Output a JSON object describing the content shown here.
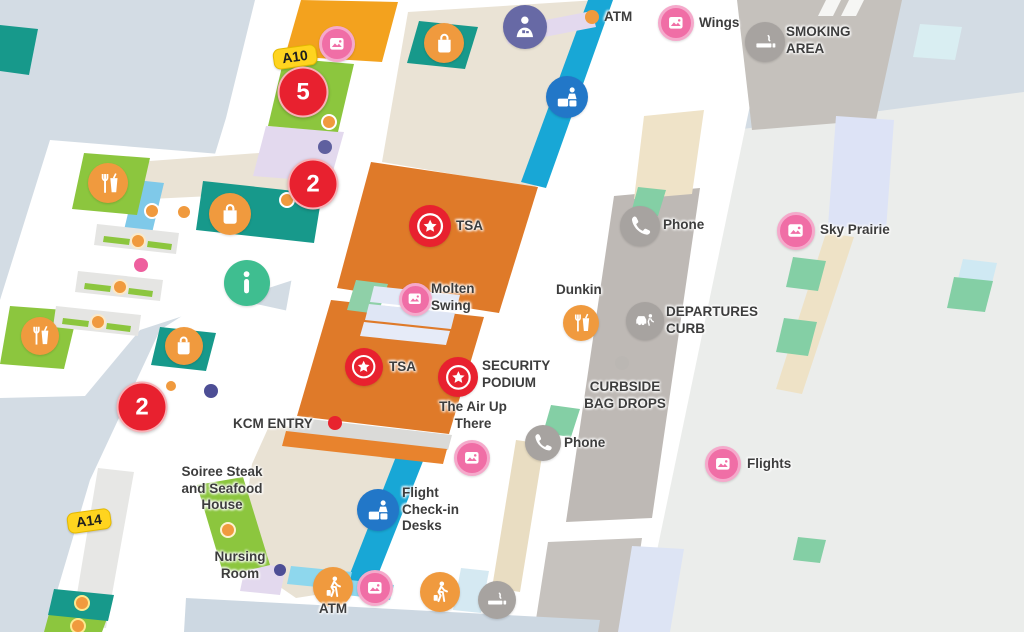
{
  "map": {
    "name": "Airport terminal map",
    "gate_tags": [
      {
        "text": "A10",
        "x": 295,
        "y": 57
      },
      {
        "text": "A14",
        "x": 89,
        "y": 521
      }
    ],
    "count_badges": [
      {
        "text": "5",
        "x": 303,
        "y": 92
      },
      {
        "text": "2",
        "x": 313,
        "y": 184
      },
      {
        "text": "2",
        "x": 142,
        "y": 407
      }
    ],
    "labels": [
      {
        "slug": "atm-top",
        "lines": [
          "ATM"
        ],
        "x": 604,
        "y": 9,
        "align": "left"
      },
      {
        "slug": "wings",
        "lines": [
          "Wings"
        ],
        "x": 699,
        "y": 15,
        "align": "left"
      },
      {
        "slug": "smoking-area",
        "lines": [
          "SMOKING",
          "AREA"
        ],
        "x": 786,
        "y": 24,
        "align": "left"
      },
      {
        "slug": "sky-prairie",
        "lines": [
          "Sky Prairie"
        ],
        "x": 820,
        "y": 222,
        "align": "left"
      },
      {
        "slug": "phone-upper",
        "lines": [
          "Phone"
        ],
        "x": 663,
        "y": 217,
        "align": "left"
      },
      {
        "slug": "departures-curb",
        "lines": [
          "DEPARTURES",
          "CURB"
        ],
        "x": 666,
        "y": 304,
        "align": "left"
      },
      {
        "slug": "dunkin",
        "lines": [
          "Dunkin"
        ],
        "x": 556,
        "y": 282,
        "align": "left"
      },
      {
        "slug": "molten-swing",
        "lines": [
          "Molten",
          "Swing"
        ],
        "x": 431,
        "y": 281,
        "align": "left"
      },
      {
        "slug": "tsa-1",
        "lines": [
          "TSA"
        ],
        "x": 456,
        "y": 218,
        "align": "left"
      },
      {
        "slug": "tsa-2",
        "lines": [
          "TSA"
        ],
        "x": 389,
        "y": 359,
        "align": "left"
      },
      {
        "slug": "security-podium",
        "lines": [
          "SECURITY",
          "PODIUM"
        ],
        "x": 482,
        "y": 358,
        "align": "left"
      },
      {
        "slug": "the-air-up-there",
        "lines": [
          "The Air Up",
          "There"
        ],
        "x": 473,
        "y": 399,
        "align": "center"
      },
      {
        "slug": "curbside-bag-drops",
        "lines": [
          "CURBSIDE",
          "BAG DROPS"
        ],
        "x": 625,
        "y": 379,
        "align": "center"
      },
      {
        "slug": "phone-lower",
        "lines": [
          "Phone"
        ],
        "x": 564,
        "y": 435,
        "align": "left"
      },
      {
        "slug": "flights",
        "lines": [
          "Flights"
        ],
        "x": 747,
        "y": 456,
        "align": "left"
      },
      {
        "slug": "kcm-entry",
        "lines": [
          "KCM ENTRY"
        ],
        "x": 233,
        "y": 416,
        "align": "left"
      },
      {
        "slug": "flight-check-in-desks",
        "lines": [
          "Flight",
          "Check-in",
          "Desks"
        ],
        "x": 402,
        "y": 485,
        "align": "left"
      },
      {
        "slug": "soiree-steak",
        "lines": [
          "Soiree Steak",
          "and Seafood",
          "House"
        ],
        "x": 222,
        "y": 464,
        "align": "center"
      },
      {
        "slug": "nursing-room",
        "lines": [
          "Nursing",
          "Room"
        ],
        "x": 240,
        "y": 549,
        "align": "center"
      },
      {
        "slug": "atm-bottom",
        "lines": [
          "ATM"
        ],
        "x": 333,
        "y": 601,
        "align": "center"
      }
    ],
    "markers": [
      {
        "icon": "art-photo",
        "x": 676,
        "y": 23,
        "d": 36
      },
      {
        "icon": "smoking",
        "x": 765,
        "y": 42,
        "d": 40
      },
      {
        "icon": "nursing-room",
        "x": 525,
        "y": 27,
        "d": 44
      },
      {
        "icon": "shopping",
        "x": 444,
        "y": 43,
        "d": 40
      },
      {
        "icon": "checkin-desk",
        "x": 567,
        "y": 97,
        "d": 42
      },
      {
        "icon": "art-photo",
        "x": 337,
        "y": 44,
        "d": 36
      },
      {
        "icon": "dining",
        "x": 108,
        "y": 183,
        "d": 40
      },
      {
        "icon": "shopping",
        "x": 230,
        "y": 214,
        "d": 42
      },
      {
        "icon": "information",
        "x": 247,
        "y": 283,
        "d": 46
      },
      {
        "icon": "tsa-checkpoint",
        "x": 430,
        "y": 226,
        "d": 42
      },
      {
        "icon": "art-photo",
        "x": 415,
        "y": 299,
        "d": 33
      },
      {
        "icon": "dining",
        "x": 581,
        "y": 323,
        "d": 36
      },
      {
        "icon": "tsa-checkpoint",
        "x": 364,
        "y": 367,
        "d": 38
      },
      {
        "icon": "tsa-checkpoint",
        "x": 458,
        "y": 377,
        "d": 40
      },
      {
        "icon": "art-photo",
        "x": 472,
        "y": 458,
        "d": 36
      },
      {
        "icon": "phone",
        "x": 640,
        "y": 226,
        "d": 40
      },
      {
        "icon": "art-photo",
        "x": 796,
        "y": 231,
        "d": 38
      },
      {
        "icon": "departures-curb",
        "x": 645,
        "y": 321,
        "d": 38
      },
      {
        "icon": "phone",
        "x": 543,
        "y": 443,
        "d": 36
      },
      {
        "icon": "art-photo",
        "x": 723,
        "y": 464,
        "d": 36
      },
      {
        "icon": "checkin-desk",
        "x": 378,
        "y": 510,
        "d": 42
      },
      {
        "icon": "shopping",
        "x": 184,
        "y": 346,
        "d": 38
      },
      {
        "icon": "dining",
        "x": 40,
        "y": 336,
        "d": 38
      },
      {
        "icon": "passenger-walk",
        "x": 333,
        "y": 587,
        "d": 40
      },
      {
        "icon": "art-photo",
        "x": 375,
        "y": 588,
        "d": 36
      },
      {
        "icon": "passenger-walk",
        "x": 440,
        "y": 592,
        "d": 40
      },
      {
        "icon": "smoking",
        "x": 497,
        "y": 600,
        "d": 38
      }
    ],
    "dots": [
      {
        "x": 592,
        "y": 17,
        "r": 7,
        "color": "#f09a3e"
      },
      {
        "x": 329,
        "y": 122,
        "r": 8,
        "color": "#f09a3e",
        "ring": "#ffffff"
      },
      {
        "x": 325,
        "y": 147,
        "r": 7,
        "color": "#5f609f"
      },
      {
        "x": 287,
        "y": 200,
        "r": 8,
        "color": "#f09a3e",
        "ring": "#ffffff"
      },
      {
        "x": 152,
        "y": 211,
        "r": 8,
        "color": "#f09a3e",
        "ring": "#ffffff"
      },
      {
        "x": 184,
        "y": 212,
        "r": 8,
        "color": "#f09a3e",
        "ring": "#ffffff"
      },
      {
        "x": 138,
        "y": 241,
        "r": 8,
        "color": "#f09a3e",
        "ring": "#fbe9c8"
      },
      {
        "x": 120,
        "y": 287,
        "r": 8,
        "color": "#f09a3e",
        "ring": "#fbe9c8"
      },
      {
        "x": 98,
        "y": 322,
        "r": 8,
        "color": "#f09a3e",
        "ring": "#fbe9c8"
      },
      {
        "x": 141,
        "y": 265,
        "r": 7,
        "color": "#ee5f9e"
      },
      {
        "x": 171,
        "y": 386,
        "r": 7,
        "color": "#f09a3e",
        "ring": "#ffffff"
      },
      {
        "x": 211,
        "y": 391,
        "r": 7,
        "color": "#4d4e95"
      },
      {
        "x": 335,
        "y": 423,
        "r": 7,
        "color": "#e8232e"
      },
      {
        "x": 622,
        "y": 363,
        "r": 7,
        "color": "#bbb7b3"
      },
      {
        "x": 228,
        "y": 530,
        "r": 8,
        "color": "#f09a3e",
        "ring": "#fdf3cf"
      },
      {
        "x": 82,
        "y": 603,
        "r": 8,
        "color": "#f09a3e",
        "ring": "#fde98e"
      },
      {
        "x": 78,
        "y": 626,
        "r": 8,
        "color": "#f09a3e",
        "ring": "#fde98e"
      },
      {
        "x": 280,
        "y": 570,
        "r": 6,
        "color": "#4d4e95"
      }
    ],
    "colors": {
      "background_apron": "#d3dce4",
      "terminal_white": "#ffffff",
      "tsa_zone_orange": "#df7a29",
      "amber_block": "#f3a21e",
      "green_block": "#8cc63e",
      "teal_block": "#17998b",
      "cyan_strip": "#18a7d6",
      "mint_kiosk": "#84cfa5",
      "beige_hall": "#eae3d5",
      "lavender": "#e3d9ee",
      "road_gray": "#beb9b5",
      "badge_red": "#e8212f",
      "poi_pink": "#f06ea6",
      "poi_orange": "#f09a3e",
      "poi_gray": "#a7a3a0",
      "poi_blue": "#2277c8",
      "poi_green": "#3fbe90",
      "poi_slate": "#6769a5",
      "gate_tag_yellow": "#ffd41f"
    }
  }
}
